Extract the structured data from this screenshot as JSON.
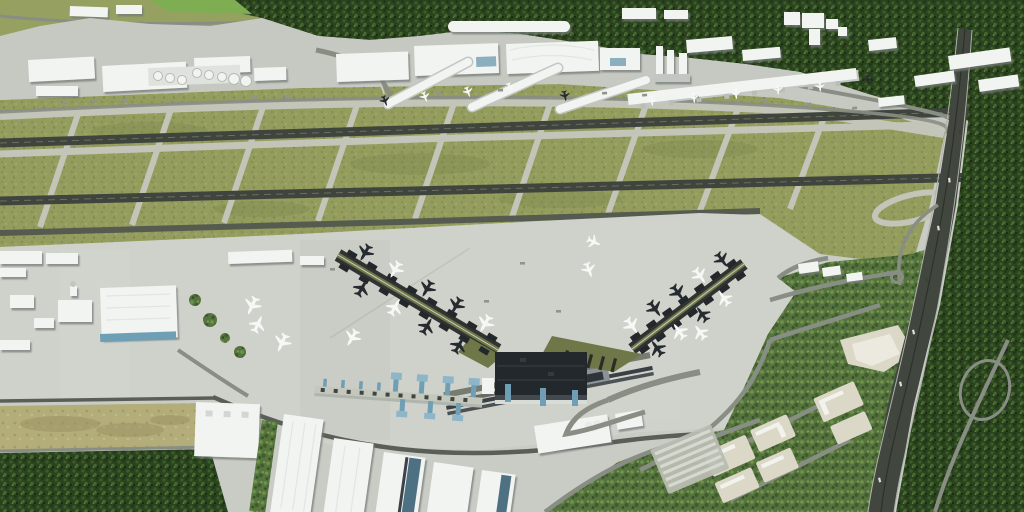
{
  "scene": {
    "type": "aerial-3d-rendering",
    "subject": "Oblique aerial rendering of a major international airport: existing terminal complex and cargo city along the top, two parallel runways with taxiways through olive grassland, a large southern apron with a new trident-shaped terminal and two diagonal piers lined with aircraft, a remote-stand pier with blue jet bridges, logistics warehouses, a planned business park with beige building plots, a motorway with interchange ramps, and dense forest framing the scene",
    "view": "high oblique, no visible text or UI elements"
  },
  "palette": {
    "base": "#c9ccc5",
    "apron": "#cfd2cb",
    "apronUpper": "#c6c9c1",
    "taxiway": "#c2c5b8",
    "taxiwayDim": "#9ba08f",
    "runway": "#3f453d",
    "runwayLight": "#6a6f62",
    "grass": "#949d5e",
    "grassDark": "#7c864d",
    "forest": "#2b421f",
    "forestLight": "#5b8a3c",
    "park": "#57743f",
    "parkDark": "#33512a",
    "tan": "#b3ad79",
    "building": "#f2f4f1",
    "buildingShade": "#c2c7c4",
    "glass": "#6f9fb4",
    "glassDark": "#31586e",
    "darkRoof": "#22282b",
    "oliveRoof": "#6f7648",
    "road": "#898e85",
    "roadDark": "#595e57",
    "highway": "#41463f",
    "beige": "#dbd8c8",
    "planeWhite": "#f6f8f6",
    "planeDark": "#262b2f",
    "clutter": "#8f958e",
    "vehicle": "#dde0d8"
  },
  "inventory": {
    "runways": 2,
    "terminal3_diagonal_piers": 2,
    "terminal3_gate_stub_pairs": 15,
    "aircraft_total": 36,
    "aircraft_light_livery": 22,
    "aircraft_dark_livery": 14,
    "fuel_tanks": 8,
    "warehouse_halls": 8,
    "business_park_pads": 9,
    "parking_rows": 6
  },
  "regions": [
    {
      "id": "forest-north",
      "label": "forest belt along the top"
    },
    {
      "id": "terminal-complex-north",
      "label": "existing terminal and cargo buildings"
    },
    {
      "id": "fuel-tank-farm",
      "label": "round fuel storage tanks"
    },
    {
      "id": "airfield",
      "label": "grass airfield with two runways and taxiways"
    },
    {
      "id": "south-apron",
      "label": "large concrete apron"
    },
    {
      "id": "terminal3",
      "label": "new terminal with dark roof and two diagonal piers"
    },
    {
      "id": "remote-stand-pier",
      "label": "low pier with blue jet bridges"
    },
    {
      "id": "cargo-west",
      "label": "western cargo hangars"
    },
    {
      "id": "warehouse-district",
      "label": "slanted logistics warehouses"
    },
    {
      "id": "business-park",
      "label": "planned development plots with parking"
    },
    {
      "id": "motorway",
      "label": "motorway with ramps and loop"
    },
    {
      "id": "forest-east",
      "label": "forest east of the motorway"
    },
    {
      "id": "forest-southwest",
      "label": "forest patch bottom left"
    },
    {
      "id": "field-southwest",
      "label": "tan farm field bottom left"
    }
  ],
  "layers": {
    "aircraft": [
      [
        365,
        253,
        210,
        0.75,
        "d"
      ],
      [
        395,
        270,
        210,
        0.75,
        "w"
      ],
      [
        427,
        289,
        210,
        0.75,
        "d"
      ],
      [
        456,
        306,
        210,
        0.75,
        "d"
      ],
      [
        485,
        324,
        210,
        0.78,
        "w"
      ],
      [
        362,
        288,
        30,
        0.75,
        "d"
      ],
      [
        395,
        307,
        30,
        0.75,
        "w"
      ],
      [
        427,
        326,
        30,
        0.75,
        "d"
      ],
      [
        459,
        345,
        30,
        0.75,
        "d"
      ],
      [
        632,
        326,
        144,
        0.75,
        "w"
      ],
      [
        655,
        309,
        144,
        0.75,
        "d"
      ],
      [
        678,
        293,
        144,
        0.75,
        "d"
      ],
      [
        700,
        276,
        144,
        0.72,
        "w"
      ],
      [
        722,
        260,
        144,
        0.7,
        "d"
      ],
      [
        657,
        348,
        324,
        0.75,
        "d"
      ],
      [
        679,
        331,
        324,
        0.75,
        "w"
      ],
      [
        702,
        314,
        324,
        0.72,
        "d"
      ],
      [
        724,
        298,
        324,
        0.7,
        "w"
      ],
      [
        252,
        306,
        205,
        0.8,
        "w"
      ],
      [
        258,
        324,
        25,
        0.75,
        "w"
      ],
      [
        282,
        343,
        205,
        0.8,
        "w"
      ],
      [
        352,
        338,
        210,
        0.75,
        "w"
      ],
      [
        594,
        242,
        115,
        0.6,
        "w"
      ],
      [
        589,
        270,
        160,
        0.65,
        "w"
      ],
      [
        700,
        332,
        324,
        0.7,
        "w"
      ],
      [
        652,
        101,
        175,
        0.45,
        "w"
      ],
      [
        694,
        98,
        175,
        0.45,
        "w"
      ],
      [
        736,
        94,
        175,
        0.45,
        "w"
      ],
      [
        778,
        90,
        175,
        0.42,
        "w"
      ],
      [
        820,
        87,
        175,
        0.42,
        "w"
      ],
      [
        425,
        97,
        160,
        0.45,
        "w"
      ],
      [
        468,
        92,
        160,
        0.45,
        "w"
      ],
      [
        510,
        88,
        160,
        0.45,
        "w"
      ],
      [
        385,
        101,
        160,
        0.45,
        "d"
      ],
      [
        565,
        96,
        170,
        0.45,
        "d"
      ],
      [
        868,
        80,
        175,
        0.4,
        "d"
      ]
    ],
    "pier_gates": [
      {
        "id": "g-gates-west",
        "x1": 338,
        "y1": 255,
        "x2": 498,
        "y2": 350,
        "n": 8,
        "ang": 30.6
      },
      {
        "id": "g-gates-east",
        "x1": 632,
        "y1": 349,
        "x2": 744,
        "y2": 264,
        "n": 7,
        "ang": -35.6
      }
    ],
    "connectors": [
      [
        40,
        227,
        80,
        108
      ],
      [
        132,
        225,
        172,
        106
      ],
      [
        224,
        223,
        264,
        104
      ],
      [
        318,
        221,
        358,
        102
      ],
      [
        415,
        219,
        455,
        100
      ],
      [
        512,
        217,
        552,
        98
      ],
      [
        608,
        214,
        648,
        99
      ],
      [
        700,
        211,
        740,
        103
      ],
      [
        790,
        209,
        826,
        112
      ]
    ],
    "clutter": [
      [
        62,
        102,
        -6
      ],
      [
        92,
        100,
        -6
      ],
      [
        122,
        99,
        -6
      ],
      [
        252,
        96,
        -4
      ],
      [
        284,
        95,
        -4
      ],
      [
        436,
        92,
        -3
      ],
      [
        466,
        90,
        -3
      ],
      [
        498,
        89,
        -3
      ],
      [
        602,
        92,
        -4
      ],
      [
        642,
        94,
        -5
      ],
      [
        694,
        96,
        -5
      ],
      [
        762,
        100,
        -6
      ],
      [
        806,
        103,
        -6
      ],
      [
        852,
        107,
        -7
      ],
      [
        330,
        268,
        0
      ],
      [
        356,
        286,
        0
      ],
      [
        520,
        262,
        0
      ],
      [
        484,
        300,
        0
      ],
      [
        556,
        310,
        0
      ]
    ],
    "vehicles": [
      [
        959,
        130,
        -4
      ],
      [
        948,
        178,
        -7
      ],
      [
        937,
        226,
        -9
      ],
      [
        925,
        278,
        -11
      ],
      [
        912,
        330,
        -12
      ],
      [
        899,
        382,
        -13
      ],
      [
        888,
        434,
        -13
      ],
      [
        878,
        478,
        -14
      ]
    ],
    "grass_mottles": [
      [
        150,
        131,
        58,
        9
      ],
      [
        420,
        164,
        70,
        11
      ],
      [
        700,
        149,
        58,
        9
      ],
      [
        262,
        209,
        48,
        8
      ],
      [
        560,
        199,
        62,
        9
      ],
      [
        852,
        180,
        36,
        7
      ]
    ],
    "tan_mottles": [
      [
        60,
        424,
        40,
        8
      ],
      [
        130,
        430,
        34,
        7
      ],
      [
        170,
        420,
        20,
        5
      ]
    ]
  }
}
